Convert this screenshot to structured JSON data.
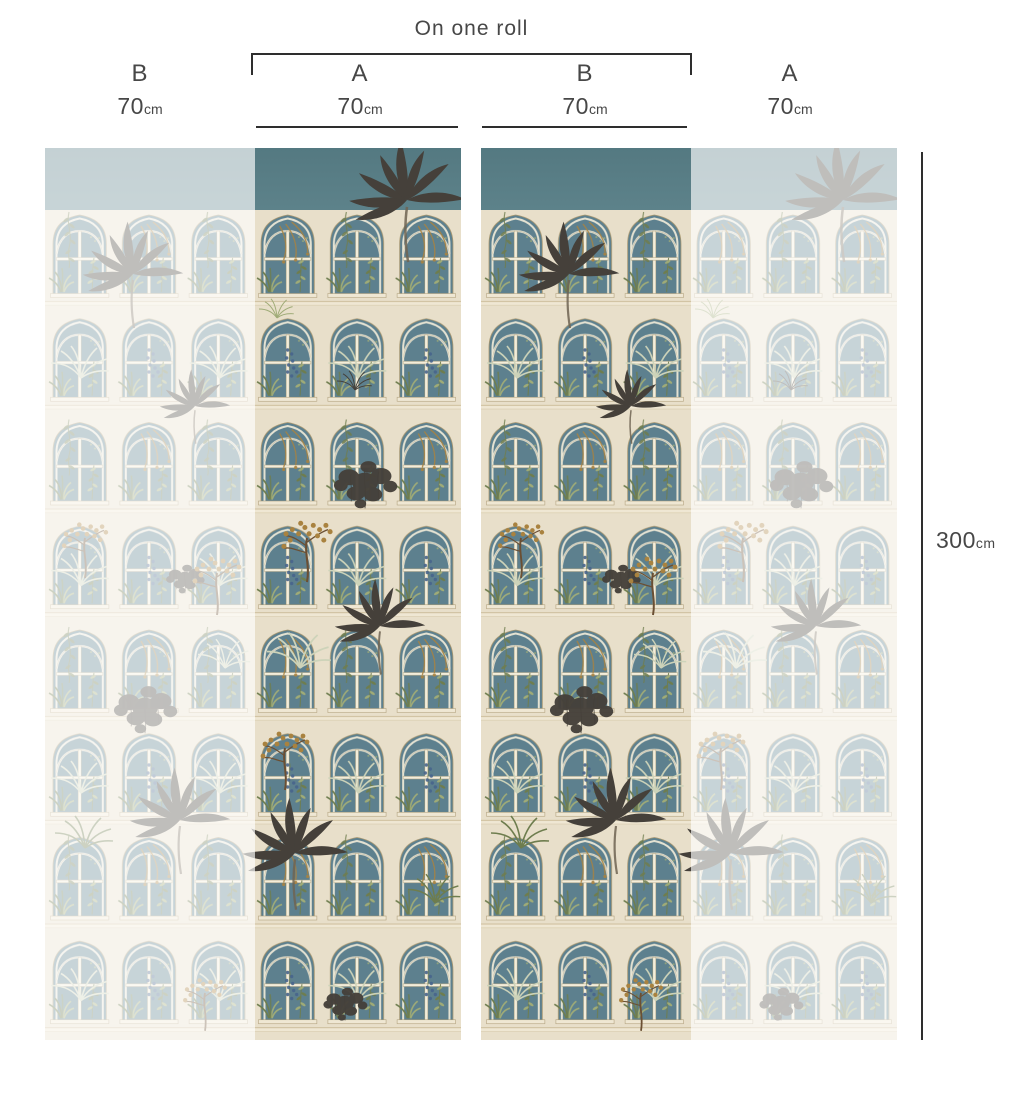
{
  "roll_label": "On one roll",
  "columns": [
    {
      "panel": "B",
      "width_value": "70",
      "width_unit": "cm",
      "on_one_roll": false
    },
    {
      "panel": "A",
      "width_value": "70",
      "width_unit": "cm",
      "on_one_roll": true
    },
    {
      "panel": "B",
      "width_value": "70",
      "width_unit": "cm",
      "on_one_roll": true
    },
    {
      "panel": "A",
      "width_value": "70",
      "width_unit": "cm",
      "on_one_roll": false
    }
  ],
  "height": {
    "value": "300",
    "unit": "cm"
  },
  "artwork_description": "Botanical conservatory facade wallpaper: gothic arched windows with teal glass, cream stonework, overflowing palms and plants; two drops shown, outer halves faded",
  "colors": {
    "sky_teal": "#587d85",
    "facade_cream": "#e8dfca",
    "frame_light": "#f3edda",
    "frame_line": "#a89770",
    "cornice_line": "#c3b28c",
    "glass_teal": "#5d808e",
    "sill_cream": "#efe7d3",
    "plant_dark": "#45403a",
    "plant_green": "#6e7d4e",
    "plant_sage": "#9fab77",
    "plant_pale": "#cdd3b9",
    "plant_brown": "#a9823f",
    "branch_brown": "#6b4f33",
    "berry_blue": "#47648c",
    "trunk_gray": "#6f6452",
    "dimension_line": "#2e2e2e",
    "label_text": "#474747",
    "fade_overlay": "#ffffff",
    "fade_opacity": "0.66"
  }
}
